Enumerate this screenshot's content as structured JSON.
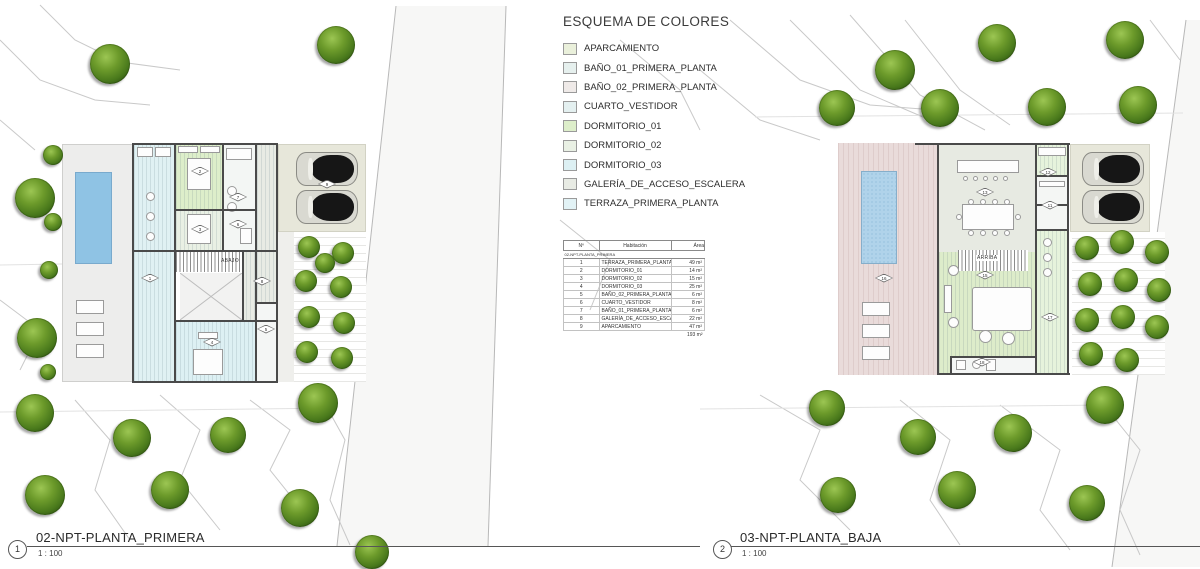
{
  "legend": {
    "title": "ESQUEMA DE COLORES",
    "items": [
      {
        "label": "APARCAMIENTO",
        "color": "#eaf0db"
      },
      {
        "label": "BAÑO_01_PRIMERA_PLANTA",
        "color": "#e6f0ee"
      },
      {
        "label": "BAÑO_02_PRIMERA_PLANTA",
        "color": "#efeae8"
      },
      {
        "label": "CUARTO_VESTIDOR",
        "color": "#e4f0f0"
      },
      {
        "label": "DORMITORIO_01",
        "color": "#ddeeca"
      },
      {
        "label": "DORMITORIO_02",
        "color": "#e9f0e4"
      },
      {
        "label": "DORMITORIO_03",
        "color": "#ddf0f3"
      },
      {
        "label": "GALERÍA_DE_ACCESO_ESCALERA",
        "color": "#e8ebe4"
      },
      {
        "label": "TERRAZA_PRIMERA_PLANTA",
        "color": "#e2f2f5"
      }
    ]
  },
  "schedule": {
    "headers": [
      "Nº",
      "Habitación",
      "Área"
    ],
    "group": "02-NPT-PLANTA_PRIMERA",
    "rows": [
      [
        "1",
        "TERRAZA_PRIMERA_PLANTA",
        "49 m²"
      ],
      [
        "2",
        "DORMITORIO_01",
        "14 m²"
      ],
      [
        "3",
        "DORMITORIO_02",
        "15 m²"
      ],
      [
        "4",
        "DORMITORIO_03",
        "25 m²"
      ],
      [
        "5",
        "BAÑO_02_PRIMERA_PLANTA",
        "6 m²"
      ],
      [
        "6",
        "CUARTO_VESTIDOR",
        "8 m²"
      ],
      [
        "7",
        "BAÑO_01_PRIMERA_PLANTA",
        "6 m²"
      ],
      [
        "8",
        "GALERÍA_DE_ACCESO_ESCALERA",
        "22 m²"
      ],
      [
        "9",
        "APARCAMIENTO",
        "47 m²"
      ]
    ],
    "total": "193 m²"
  },
  "views": [
    {
      "number": "1",
      "title": "02-NPT-PLANTA_PRIMERA",
      "scale": "1 : 100"
    },
    {
      "number": "2",
      "title": "03-NPT-PLANTA_BAJA",
      "scale": "1 : 100"
    }
  ],
  "plans": {
    "left": {
      "stair_label": "ABAJO",
      "tags": [
        {
          "x": 150,
          "y": 278,
          "n": "1"
        },
        {
          "x": 200,
          "y": 171,
          "n": "2"
        },
        {
          "x": 200,
          "y": 229,
          "n": "3"
        },
        {
          "x": 212,
          "y": 342,
          "n": "4"
        },
        {
          "x": 266,
          "y": 329,
          "n": "5"
        },
        {
          "x": 238,
          "y": 224,
          "n": "6"
        },
        {
          "x": 238,
          "y": 197,
          "n": "7"
        },
        {
          "x": 262,
          "y": 281,
          "n": "8"
        },
        {
          "x": 327,
          "y": 184,
          "n": "9"
        }
      ]
    },
    "right": {
      "stair_label": "ARRIBA",
      "tags": [
        {
          "x": 884,
          "y": 278,
          "n": "16"
        },
        {
          "x": 985,
          "y": 192,
          "n": "13"
        },
        {
          "x": 985,
          "y": 275,
          "n": "15"
        },
        {
          "x": 1050,
          "y": 317,
          "n": "17"
        },
        {
          "x": 1050,
          "y": 205,
          "n": "11"
        },
        {
          "x": 1048,
          "y": 172,
          "n": "12"
        },
        {
          "x": 982,
          "y": 362,
          "n": "18"
        }
      ]
    }
  },
  "site": {
    "trees": [
      {
        "x": 110,
        "y": 64,
        "d": 40
      },
      {
        "x": 336,
        "y": 45,
        "d": 38
      },
      {
        "x": 53,
        "y": 155,
        "d": 20
      },
      {
        "x": 35,
        "y": 198,
        "d": 40
      },
      {
        "x": 53,
        "y": 222,
        "d": 18
      },
      {
        "x": 49,
        "y": 270,
        "d": 18
      },
      {
        "x": 37,
        "y": 338,
        "d": 40
      },
      {
        "x": 48,
        "y": 372,
        "d": 16
      },
      {
        "x": 35,
        "y": 413,
        "d": 38
      },
      {
        "x": 45,
        "y": 495,
        "d": 40
      },
      {
        "x": 132,
        "y": 438,
        "d": 38
      },
      {
        "x": 228,
        "y": 435,
        "d": 36
      },
      {
        "x": 170,
        "y": 490,
        "d": 38
      },
      {
        "x": 300,
        "y": 508,
        "d": 38
      },
      {
        "x": 318,
        "y": 403,
        "d": 40
      },
      {
        "x": 372,
        "y": 552,
        "d": 34
      },
      {
        "x": 997,
        "y": 43,
        "d": 38
      },
      {
        "x": 1125,
        "y": 40,
        "d": 38
      },
      {
        "x": 895,
        "y": 70,
        "d": 40
      },
      {
        "x": 837,
        "y": 108,
        "d": 36
      },
      {
        "x": 940,
        "y": 108,
        "d": 38
      },
      {
        "x": 1047,
        "y": 107,
        "d": 38
      },
      {
        "x": 1138,
        "y": 105,
        "d": 38
      },
      {
        "x": 827,
        "y": 408,
        "d": 36
      },
      {
        "x": 918,
        "y": 437,
        "d": 36
      },
      {
        "x": 1013,
        "y": 433,
        "d": 38
      },
      {
        "x": 1105,
        "y": 405,
        "d": 38
      },
      {
        "x": 838,
        "y": 495,
        "d": 36
      },
      {
        "x": 957,
        "y": 490,
        "d": 38
      },
      {
        "x": 1087,
        "y": 503,
        "d": 36
      }
    ],
    "garden_trees": [
      {
        "x": 309,
        "y": 247,
        "d": 22
      },
      {
        "x": 343,
        "y": 253,
        "d": 22
      },
      {
        "x": 325,
        "y": 263,
        "d": 20
      },
      {
        "x": 306,
        "y": 281,
        "d": 22
      },
      {
        "x": 341,
        "y": 287,
        "d": 22
      },
      {
        "x": 309,
        "y": 317,
        "d": 22
      },
      {
        "x": 344,
        "y": 323,
        "d": 22
      },
      {
        "x": 307,
        "y": 352,
        "d": 22
      },
      {
        "x": 342,
        "y": 358,
        "d": 22
      },
      {
        "x": 1087,
        "y": 248,
        "d": 24
      },
      {
        "x": 1122,
        "y": 242,
        "d": 24
      },
      {
        "x": 1157,
        "y": 252,
        "d": 24
      },
      {
        "x": 1090,
        "y": 284,
        "d": 24
      },
      {
        "x": 1126,
        "y": 280,
        "d": 24
      },
      {
        "x": 1159,
        "y": 290,
        "d": 24
      },
      {
        "x": 1087,
        "y": 320,
        "d": 24
      },
      {
        "x": 1123,
        "y": 317,
        "d": 24
      },
      {
        "x": 1157,
        "y": 327,
        "d": 24
      },
      {
        "x": 1091,
        "y": 354,
        "d": 24
      },
      {
        "x": 1127,
        "y": 360,
        "d": 24
      }
    ]
  },
  "colors": {
    "wall": "#4a4a4a",
    "pool_primera": "#8fc3e4",
    "pool_baja": "#b0d3ea",
    "deck": "#ededec",
    "parking_paving": "#e7e7da",
    "terrace_pink": "#e9dbda",
    "kitchen_dining": "#e7eae2",
    "living_green": "#ddecca",
    "porch_green": "#e6f3dc",
    "road": "#f7f7f6",
    "contour_line": "#c9c9c9",
    "tree_dark": "#274a0e",
    "tree_light": "#9cc653"
  }
}
